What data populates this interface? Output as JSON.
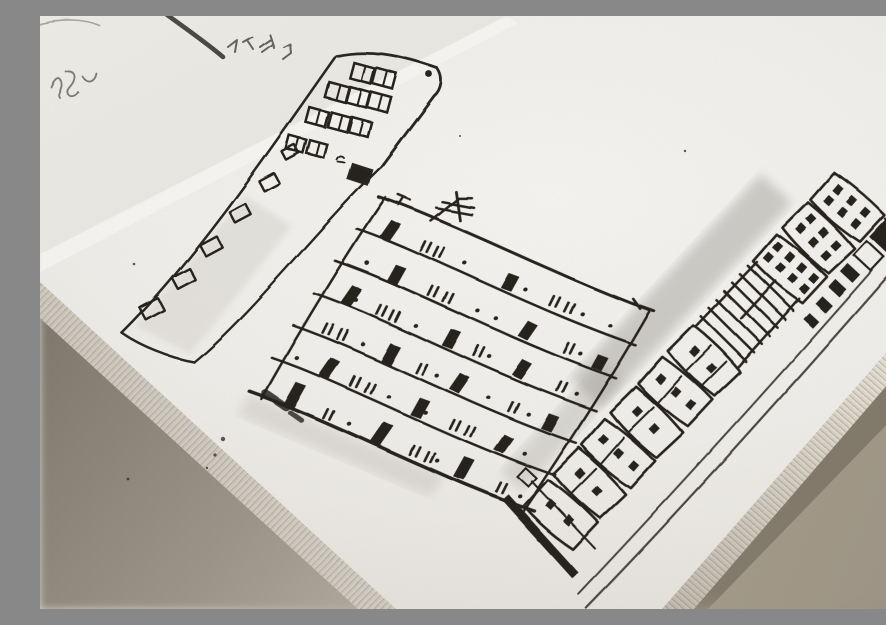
{
  "scene": {
    "description": "Close-up photograph of an open sketchbook lying diagonally on a grey-beige desk. The page carries black ink sketches of three tall apartment buildings: a narrow slab with rows of outlined windows (left), a wide six-storey block with wavy floor bands, dark little windows and a rooftop TV antenna (middle), and a tall tower of stacked units with dotted windows, a long narrow side face and soft pencil shading (right). The facing page peeks in at the top-left corner with a short upside-down handwritten word underlined by a heavy slanted stroke and a small cursive scribble. The stacked page edges of the book and the desk surface are visible along the bottom corners.",
    "objects": [
      {
        "name": "sketchbook-page",
        "detail": "white textured paper, main right-hand page"
      },
      {
        "name": "facing-page-corner",
        "detail": "top-left corner of the opposite page with handwriting"
      },
      {
        "name": "building-left-slab",
        "detail": "narrow high-rise slab tapering toward lower-left, outlined windows"
      },
      {
        "name": "building-middle-block",
        "detail": "wide block with six wavy floor bands and rooftop antenna"
      },
      {
        "name": "building-right-tower",
        "detail": "tall stacked tower with dot windows, ladder-like mid section, long side face, pencil shadow"
      },
      {
        "name": "page-edge-stack",
        "detail": "layered paper edges along the book rim"
      },
      {
        "name": "desk-surface",
        "detail": "grey-beige tabletop at the lower corners"
      }
    ],
    "handwriting": {
      "top_word": "short upside-down word with heavy slanted underline (illegible)",
      "left_scribble": "small cursive scribble (illegible)"
    },
    "colors": {
      "ink": "#26231f",
      "ink_light": "#4a463f",
      "paper": "#f0eeea",
      "paper_shaded": "#dcd8d1",
      "desk_left": "#d6d3cb",
      "desk_right": "#a39a8d",
      "shadow": "#6d675d",
      "pencil": "#6a6560"
    }
  },
  "sketch": {
    "left_slab": {
      "band_windows": [
        [
          112,
          293,
          1.15
        ],
        [
          144,
          263,
          1.1
        ],
        [
          171,
          230,
          1.05
        ],
        [
          200,
          197,
          1.0
        ],
        [
          229,
          166,
          0.95
        ],
        [
          250,
          136,
          0.8
        ]
      ],
      "head_windows": [
        [
          322,
          57,
          1
        ],
        [
          344,
          62,
          1
        ],
        [
          297,
          76,
          1
        ],
        [
          318,
          81,
          1
        ],
        [
          339,
          86,
          1
        ],
        [
          277,
          101,
          0.95
        ],
        [
          299,
          106,
          0.95
        ],
        [
          320,
          111,
          0.95
        ],
        [
          256,
          128,
          0.85
        ],
        [
          277,
          133,
          0.85
        ]
      ],
      "solid_window": [
        320,
        159
      ],
      "tiny_mark": [
        301,
        144
      ]
    },
    "mid_block": {
      "width": 288,
      "band_lines_y": [
        0,
        38,
        76,
        114,
        152,
        190,
        230
      ],
      "bands": [
        {
          "solids": [
            [
              16,
              20
            ],
            [
              148,
              17
            ]
          ],
          "ticks": [
            58,
            72,
            198,
            214
          ],
          "dots": [
            104,
            170,
            232,
            262
          ]
        },
        {
          "solids": [
            [
              46,
              19
            ],
            [
              188,
              18
            ],
            [
              268,
              15
            ]
          ],
          "ticks": [
            88,
            104,
            236
          ],
          "dots": [
            20,
            140,
            160,
            252
          ]
        },
        {
          "solids": [
            [
              18,
              20
            ],
            [
              128,
              19
            ],
            [
              204,
              18
            ]
          ],
          "ticks": [
            54,
            68,
            160,
            250
          ],
          "dots": [
            30,
            95,
            175,
            270
          ]
        },
        {
          "solids": [
            [
              84,
              20
            ],
            [
              158,
              19
            ],
            [
              258,
              17
            ]
          ],
          "ticks": [
            18,
            34,
            120,
            220
          ],
          "dots": [
            60,
            140,
            196,
            240
          ]
        },
        {
          "solids": [
            [
              38,
              21
            ],
            [
              138,
              20
            ],
            [
              228,
              19
            ]
          ],
          "ticks": [
            70,
            86,
            178,
            194
          ],
          "dots": [
            10,
            110,
            150,
            258
          ]
        },
        {
          "solids": [
            [
              24,
              25
            ],
            [
              118,
              23
            ],
            [
              208,
              23
            ]
          ],
          "ticks": [
            64,
            158,
            174,
            252
          ],
          "dots": [
            90,
            186,
            276
          ]
        }
      ]
    },
    "right_tower": {
      "jitter": [
        -2,
        2.5,
        -1.8,
        0,
        0,
        2,
        -1.5,
        2.5,
        -2,
        1.8,
        -1.2
      ],
      "blocks": [
        {
          "dots": 6
        },
        {
          "dots": 6
        },
        {
          "dots": 8
        },
        {
          "ladder": true
        },
        {
          "ladder": true
        },
        {
          "dots": 2,
          "divs": 2
        },
        {
          "dots": 3,
          "divs": 1
        },
        {
          "dots": 2,
          "divs": 1
        },
        {
          "dots": 3,
          "divs": 1
        },
        {
          "dots": 2,
          "divs": 1
        },
        {
          "dots": 2,
          "divs": 0
        }
      ],
      "face_windows": [
        [
          73,
          -2,
          26,
          28,
          1
        ],
        [
          73,
          32,
          23,
          19,
          0
        ],
        [
          75,
          62,
          15,
          9,
          1
        ],
        [
          77,
          82,
          13,
          8,
          1
        ],
        [
          79,
          103,
          12,
          8,
          1
        ],
        [
          81,
          124,
          11,
          7,
          1
        ]
      ]
    },
    "specks": [
      [
        869,
        158,
        1.6
      ],
      [
        877,
        173,
        1.2
      ],
      [
        861,
        187,
        1.0
      ],
      [
        183,
        423,
        2.2
      ],
      [
        175,
        439,
        1.6
      ],
      [
        167,
        452,
        1.2
      ],
      [
        88,
        463,
        1.4
      ],
      [
        531,
        297,
        1.1
      ],
      [
        94,
        248,
        1.3
      ],
      [
        251,
        332,
        1.0
      ],
      [
        420,
        120,
        1.0
      ],
      [
        645,
        135,
        1.2
      ]
    ]
  }
}
